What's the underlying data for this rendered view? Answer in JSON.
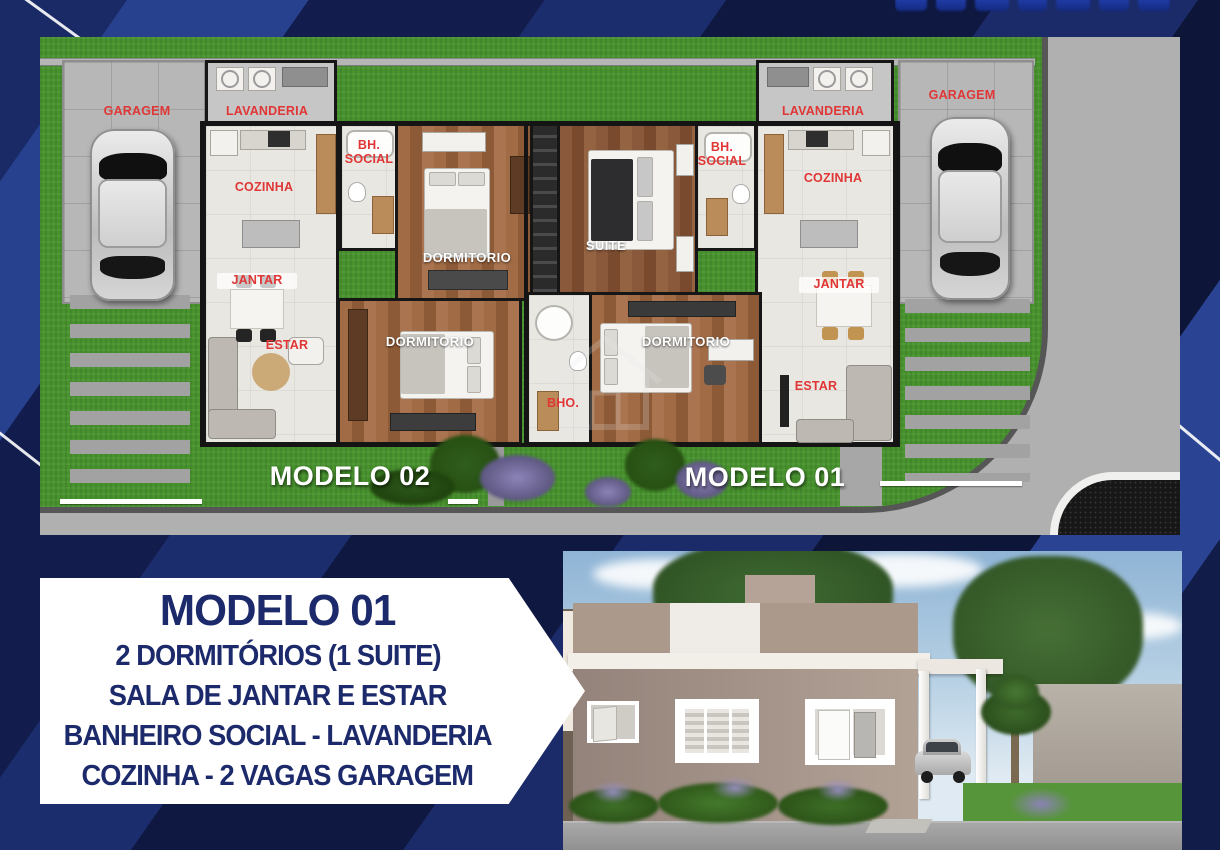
{
  "floorplan": {
    "model_02_label": "MODELO 02",
    "model_01_label": "MODELO 01",
    "unit_left": {
      "garage": "GARAGEM",
      "laundry": "LAVANDERIA",
      "kitchen": "COZINHA",
      "bathroom": "BH. SOCIAL",
      "dining": "JANTAR",
      "living": "ESTAR",
      "bedroom_top": "DORMITORIO",
      "bedroom_bottom": "DORMITORIO"
    },
    "unit_right": {
      "garage": "GARAGEM",
      "laundry": "LAVANDERIA",
      "kitchen": "COZINHA",
      "bathroom": "BH. SOCIAL",
      "suite": "SUITE",
      "dining": "JANTAR",
      "living": "ESTAR",
      "bedroom": "DORMITORIO",
      "suite_bathroom": "BHO."
    }
  },
  "banner": {
    "title": "MODELO 01",
    "lines": [
      "2 DORMITÓRIOS (1 SUITE)",
      "SALA DE JANTAR E ESTAR",
      "BANHEIRO SOCIAL - LAVANDERIA",
      "COZINHA - 2 VAGAS GARAGEM"
    ]
  },
  "colors": {
    "label_red": "#e03636",
    "banner_text": "#1c2a6b",
    "grass_green": "#47922d",
    "background_navy": "#101a45"
  }
}
